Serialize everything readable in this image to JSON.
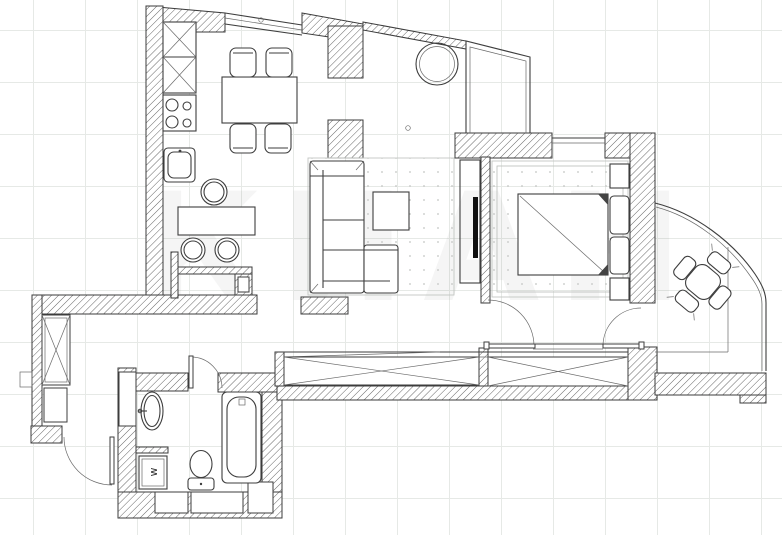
{
  "document": {
    "type": "apartment-floor-plan",
    "style": "CAD black-and-white line drawing on light grid"
  },
  "canvas": {
    "background": "#ffffff",
    "grid_color": "#e6e9e6",
    "wall_line_color": "#3b3b3b",
    "furniture_line_color": "#3e3e3e",
    "tv_color": "#111111"
  },
  "watermark": {
    "text": "КИАН"
  },
  "annotations": {
    "washing_machine_label": "w"
  },
  "rooms": [
    {
      "name": "kitchen-dining",
      "furniture": [
        "tall cabinet with cross symbol",
        "4-burner stove",
        "kitchen sink",
        "round side table",
        "dining table",
        "4 chairs",
        "bar counter",
        "2 round bar stools",
        "low partition wall"
      ]
    },
    {
      "name": "living-room",
      "furniture": [
        "corner sofa",
        "square coffee table",
        "rug with dots",
        "tv unit",
        "wall tv",
        "round hanging chair by window"
      ]
    },
    {
      "name": "bedroom",
      "furniture": [
        "double bed",
        "2 pillows",
        "2 nightstands",
        "dresser",
        "rug with dots",
        "window",
        "glazed bay corner"
      ]
    },
    {
      "name": "hallway-corridor",
      "furniture": [
        "built-in wardrobe left (cross symbol)",
        "built-in wardrobe right (cross symbol)",
        "entry wardrobe (cross symbol)",
        "shoe cabinet",
        "entry door with swing arc"
      ]
    },
    {
      "name": "bathroom",
      "furniture": [
        "oval washbasin",
        "washing machine",
        "toilet",
        "bathtub",
        "duct shaft",
        "two floor niches"
      ]
    },
    {
      "name": "balcony",
      "furniture": [
        "curved panoramic glazing",
        "round table rotated 45°",
        "4 small chairs"
      ]
    }
  ],
  "doors": [
    "bedroom door",
    "balcony door",
    "bathroom door",
    "entry door"
  ]
}
